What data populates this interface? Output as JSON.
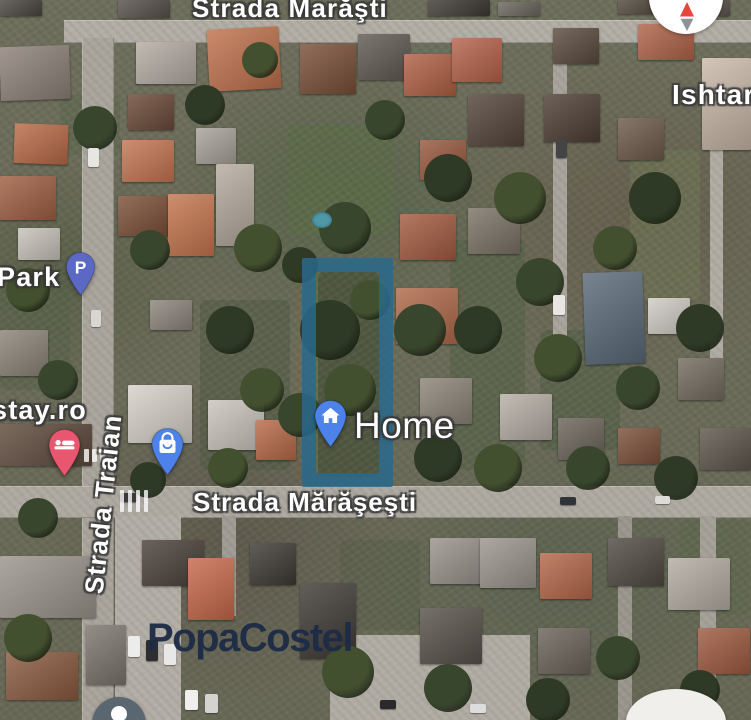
{
  "map": {
    "streets": {
      "top": "Strada Marăşti",
      "middle": "Strada Mărăşeşti",
      "left": "Strada Traian"
    },
    "places": {
      "park": "Park",
      "stay": "stay.ro",
      "ishtar": "Ishtar",
      "home": "Home"
    },
    "watermark": "PopaCostel",
    "watermark_color": "#1d2b47",
    "parcel_color": "rgba(41,105,140,0.85)",
    "markers": {
      "parking": {
        "letter": "P",
        "color": "#5b68c4"
      },
      "hotel": {
        "color": "#e9566f"
      },
      "shopping": {
        "color": "#4d82ea"
      },
      "home": {
        "color": "#4d82ea"
      },
      "partial": {
        "color": "#5b6770"
      }
    },
    "compass": {
      "north_color": "#e8453c",
      "south_color": "#8e9399"
    }
  }
}
